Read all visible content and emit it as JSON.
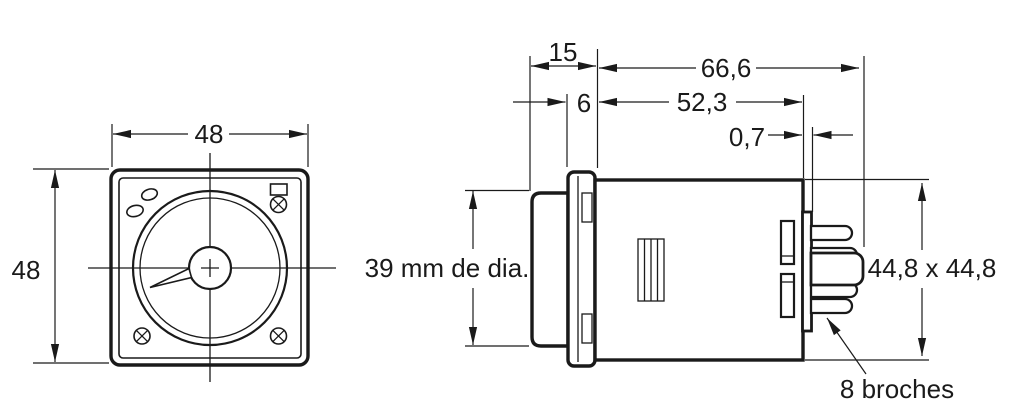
{
  "drawing": {
    "front_view": {
      "width": "48",
      "height": "48"
    },
    "side_view": {
      "bezel_depth": "15",
      "overall_depth": "66,6",
      "flange_width": "6",
      "body_depth": "52,3",
      "plate_thickness": "0,7",
      "bezel_diameter": "39 mm de dia.",
      "socket_dimensions": "44,8 x 44,8",
      "pin_count_label": "8 broches"
    },
    "colors": {
      "ink": "#1a1a1a",
      "paper": "#ffffff"
    }
  }
}
